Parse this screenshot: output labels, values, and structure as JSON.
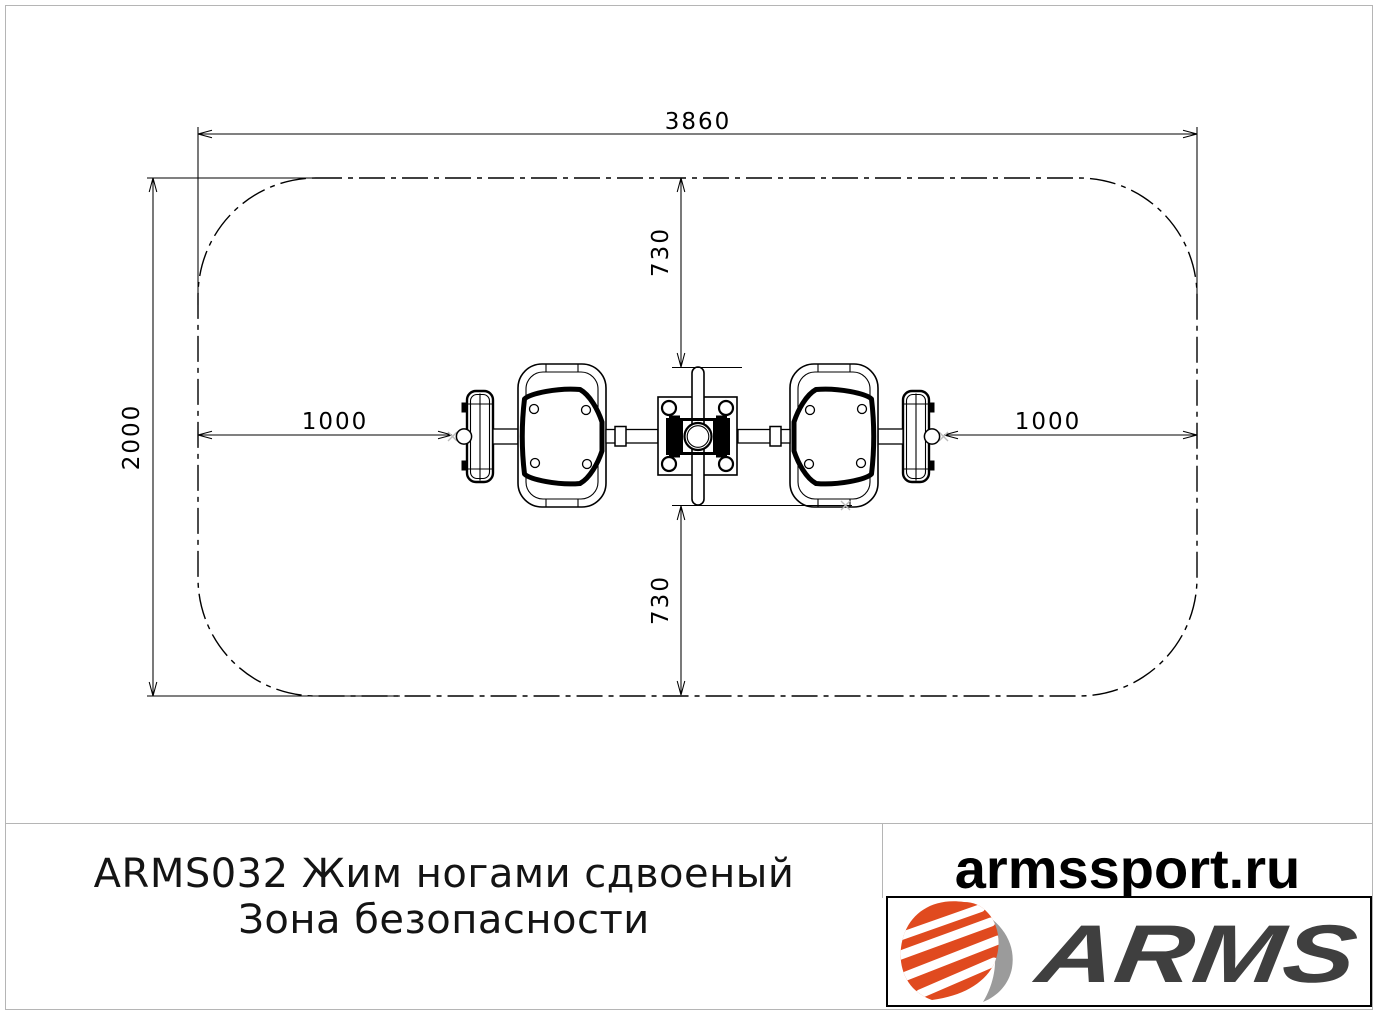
{
  "drawing": {
    "dims": {
      "width": "3860",
      "height": "2000",
      "offset_top": "730",
      "offset_bottom": "730",
      "offset_left": "1000",
      "offset_right": "1000"
    }
  },
  "title_block": {
    "line1": "ARMS032 Жим ногами сдвоеный",
    "line2": "Зона безопасности"
  },
  "branding": {
    "website": "armssport.ru",
    "logo_text": "ARMS",
    "colors": {
      "logo_orange": "#e04a1f",
      "logo_gray": "#9b9b9b",
      "logo_text_dark": "#3f3f3f",
      "frame_gray": "#b5b5b5"
    }
  }
}
